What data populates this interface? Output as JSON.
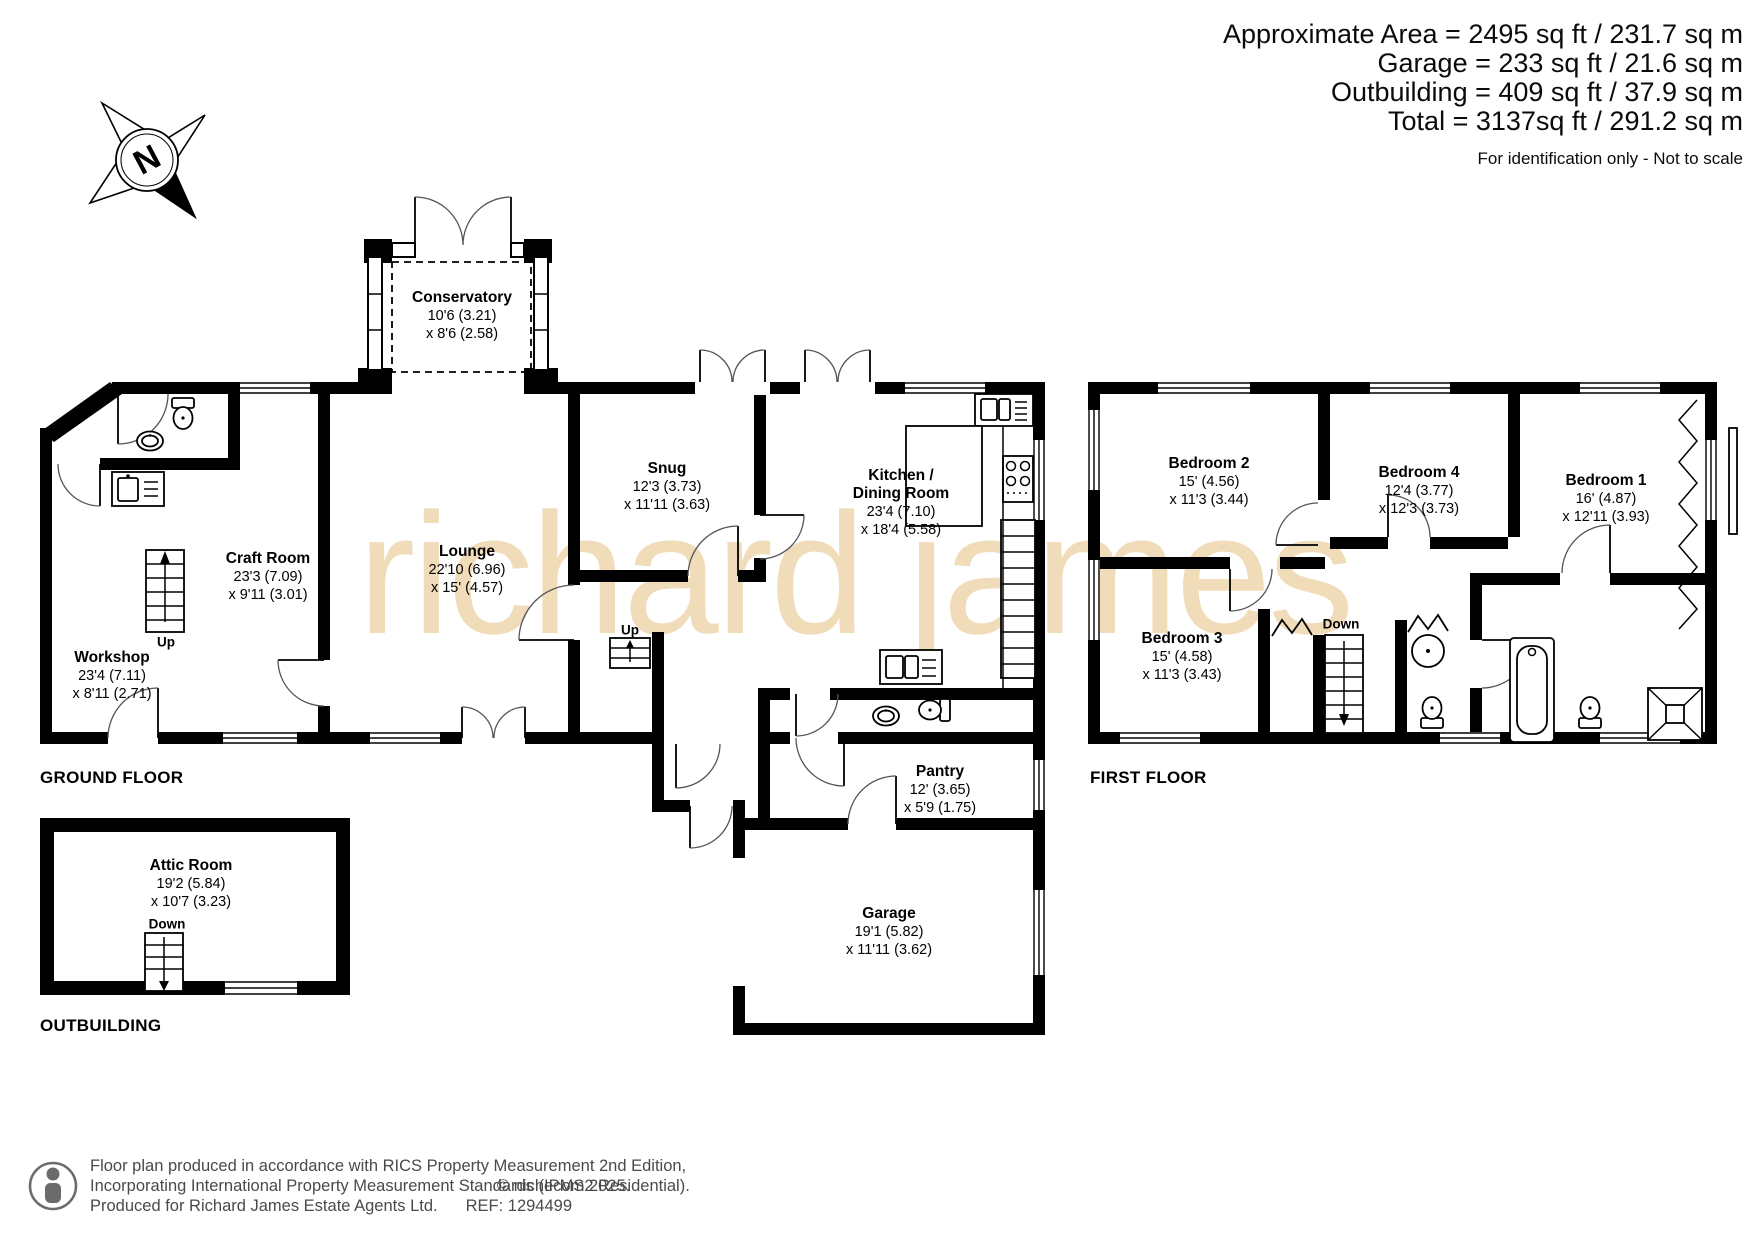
{
  "header": {
    "area_line1": "Approximate Area  = 2495 sq ft / 231.7 sq m",
    "area_line2": "Garage = 233 sq ft / 21.6 sq m",
    "area_line3": "Outbuilding = 409 sq ft / 37.9 sq m",
    "area_line4": "Total = 3137sq ft / 291.2 sq m",
    "disclaimer": "For identification only - Not to scale"
  },
  "compass": {
    "north_label": "N"
  },
  "watermark": "richard james",
  "floors": {
    "ground": {
      "title": "GROUND FLOOR",
      "rooms": [
        {
          "name": "Conservatory",
          "dim1": "10'6 (3.21)",
          "dim2": "x 8'6 (2.58)"
        },
        {
          "name": "Craft Room",
          "dim1": "23'3 (7.09)",
          "dim2": "x 9'11 (3.01)"
        },
        {
          "name": "Workshop",
          "dim1": "23'4 (7.11)",
          "dim2": "x 8'11 (2.71)"
        },
        {
          "name": "Lounge",
          "dim1": "22'10 (6.96)",
          "dim2": "x 15' (4.57)"
        },
        {
          "name": "Snug",
          "dim1": "12'3 (3.73)",
          "dim2": "x 11'11 (3.63)"
        },
        {
          "name": "Kitchen /",
          "name2": "Dining Room",
          "dim1": "23'4 (7.10)",
          "dim2": "x 18'4 (5.58)"
        },
        {
          "name": "Pantry",
          "dim1": "12' (3.65)",
          "dim2": "x 5'9 (1.75)"
        },
        {
          "name": "Garage",
          "dim1": "19'1 (5.82)",
          "dim2": "x 11'11 (3.62)"
        }
      ]
    },
    "first": {
      "title": "FIRST FLOOR",
      "rooms": [
        {
          "name": "Bedroom 2",
          "dim1": "15' (4.56)",
          "dim2": "x 11'3 (3.44)"
        },
        {
          "name": "Bedroom 4",
          "dim1": "12'4 (3.77)",
          "dim2": "x 12'3 (3.73)"
        },
        {
          "name": "Bedroom 1",
          "dim1": "16' (4.87)",
          "dim2": "x 12'11 (3.93)"
        },
        {
          "name": "Bedroom 3",
          "dim1": "15' (4.58)",
          "dim2": "x 11'3 (3.43)"
        }
      ]
    },
    "outbuilding": {
      "title": "OUTBUILDING",
      "rooms": [
        {
          "name": "Attic Room",
          "dim1": "19'2 (5.84)",
          "dim2": "x 10'7 (3.23)"
        }
      ]
    }
  },
  "stairs": {
    "up": "Up",
    "down": "Down"
  },
  "footer": {
    "line1": "Floor plan produced in accordance with RICS Property Measurement 2nd Edition,",
    "line2": "Incorporating International Property Measurement Standards (IPMS2 Residential).",
    "copyright": "© nichecom 2025.",
    "line3": "Produced for Richard James Estate Agents Ltd.",
    "ref": "REF: 1294499"
  }
}
